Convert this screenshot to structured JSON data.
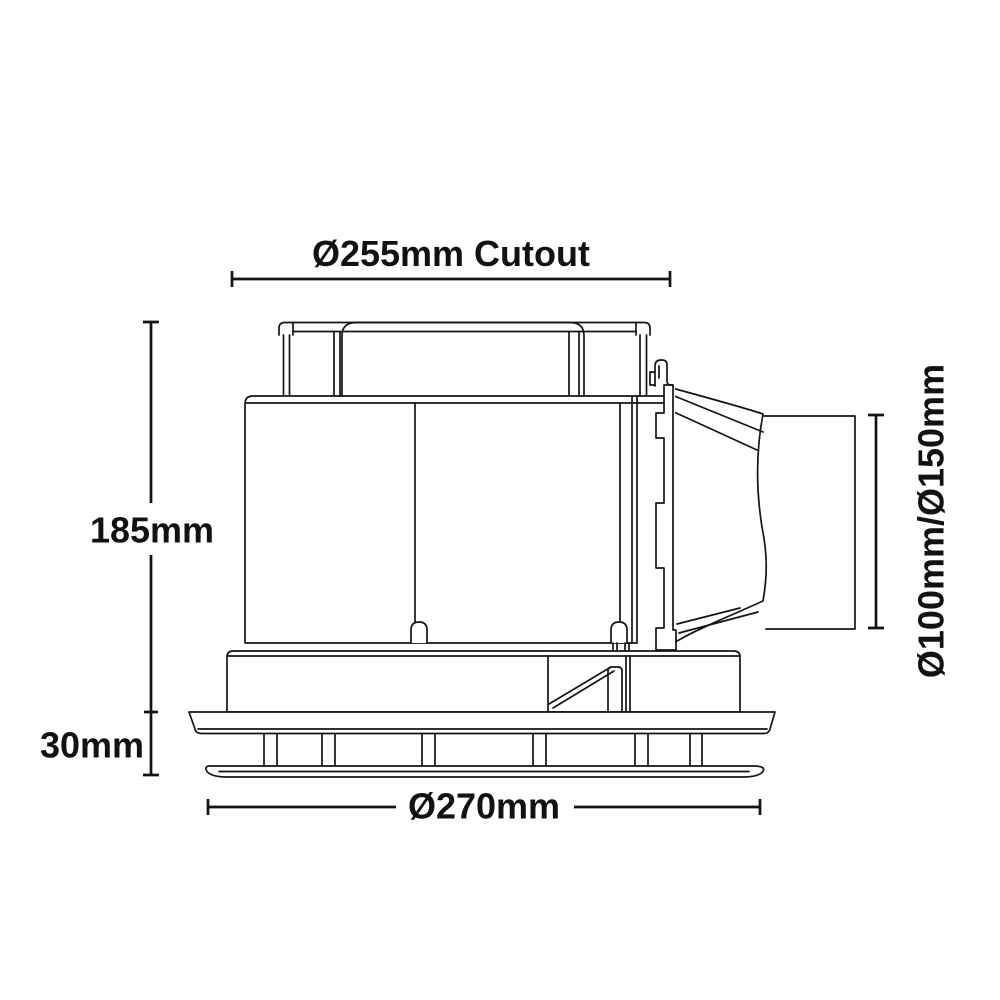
{
  "diagram": {
    "subject": "exhaust-fan-side-elevation-dimension-drawing",
    "background_color": "#ffffff",
    "line_color": "#141414",
    "labels": {
      "cutout": "Ø255mm Cutout",
      "body_height": "185mm",
      "flange_height": "30mm",
      "fascia_diameter": "Ø270mm",
      "duct_diameter": "Ø100mm/Ø150mm"
    }
  }
}
